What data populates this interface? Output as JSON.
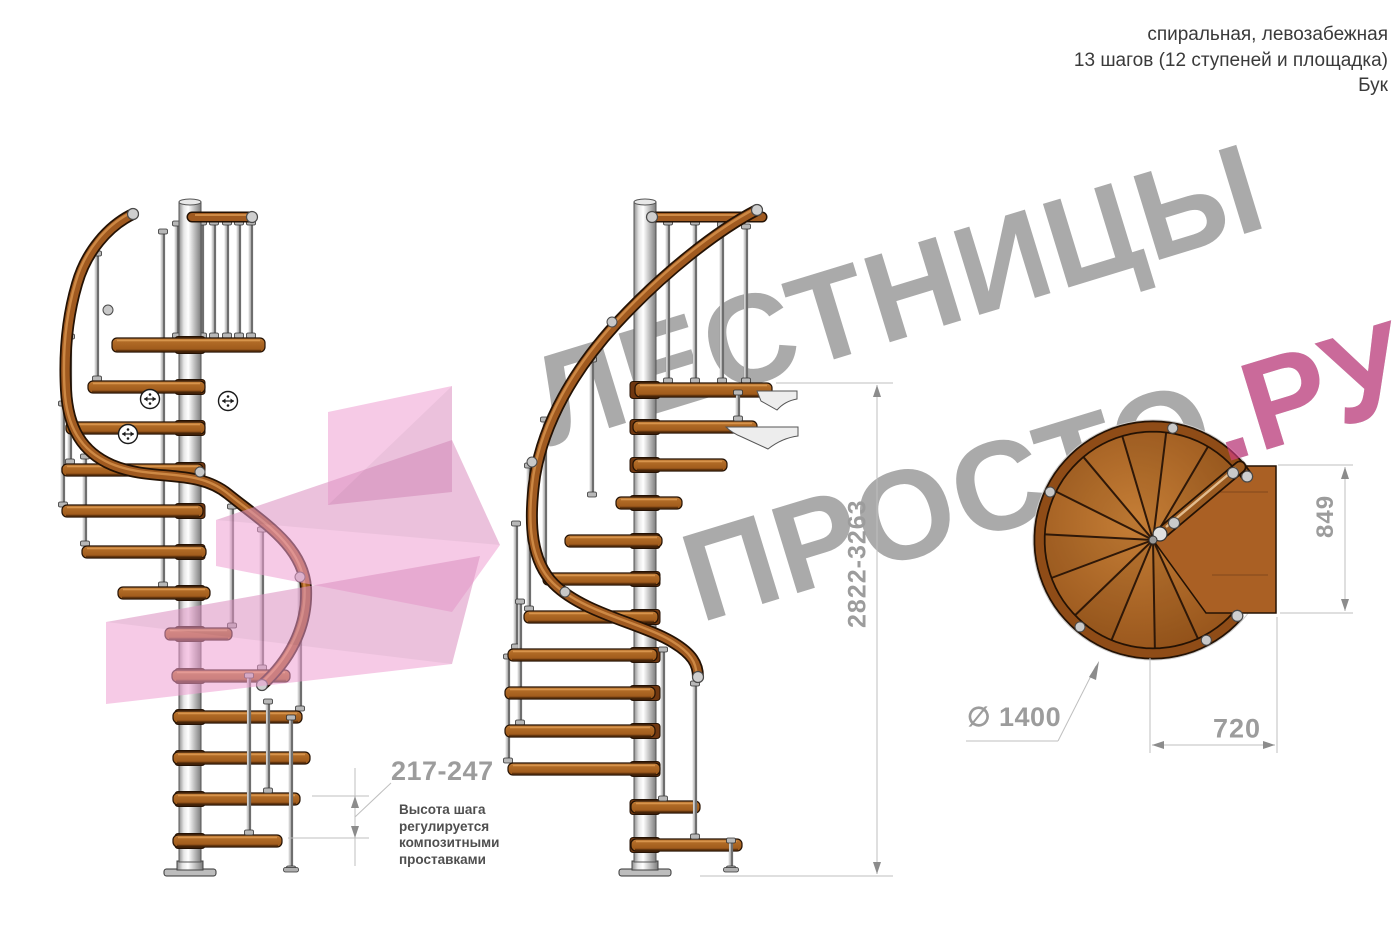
{
  "product_header": {
    "type_line": "спиральная, левозабежная",
    "steps_line": "13 шагов (12 ступеней и площадка)",
    "material_line": "Бук"
  },
  "watermark": {
    "word1": "ЛЕСТНИЦЫ",
    "word2": "ПРОСТО",
    "suffix": ".РУ"
  },
  "dimensions": {
    "step_height": "217-247",
    "step_height_note": "Высота шага\nрегулируется\nкомпозитными\nпроставками",
    "total_height": "2822-3263",
    "platform_depth": "849",
    "platform_width": "720",
    "diameter": "∅ 1400"
  },
  "colors": {
    "wood": "#9a5618",
    "wood_light": "#c8853f",
    "wood_dark": "#6f3710",
    "outline": "#241204",
    "metal": "#c9c9c9",
    "dimension_line": "#bfbfbf",
    "dimension_text": "#9c9c9c",
    "note_text": "#4f4f4f",
    "header_text": "#3a3a3a",
    "watermark_gray": "#8a8a8a",
    "watermark_pink": "#e0408f",
    "logo_pink": "#ee9ed2"
  }
}
